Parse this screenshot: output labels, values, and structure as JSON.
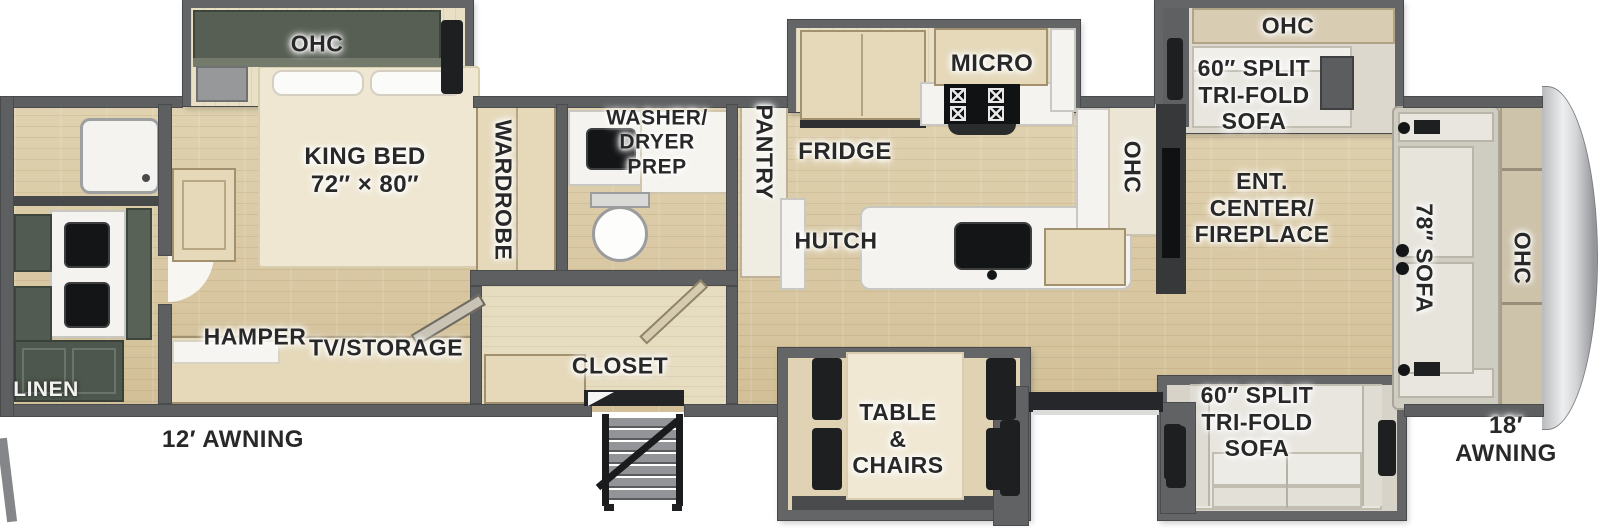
{
  "meta": {
    "type": "rv-fifth-wheel-floorplan",
    "width_px": 1600,
    "height_px": 528
  },
  "colors": {
    "wall": "#5e5f61",
    "floor_wood": "#d9c8a6",
    "cabinet_wood": "#e5d9ba",
    "cabinet_dark_green": "#525b51",
    "counter_white": "#f4f3ef",
    "sofa_fabric": "#e9e6e0",
    "front_cap_silver": "#c9cacc",
    "label_text": "#282828"
  },
  "bedroom": {
    "ohc": "OHC",
    "king_bed": [
      "KING BED",
      "72″ × 80″"
    ],
    "wardrobe": "WARDROBE",
    "hamper": "HAMPER",
    "tv_storage": "TV/STORAGE"
  },
  "rear_bath": {
    "linen": "LINEN"
  },
  "mid_bath": {
    "washer_dryer": [
      "WASHER/",
      "DRYER",
      "PREP"
    ],
    "pantry": "PANTRY"
  },
  "kitchen": {
    "micro": "MICRO",
    "fridge": "FRIDGE",
    "hutch": "HUTCH",
    "ohc": "OHC"
  },
  "living": {
    "ent_center": [
      "ENT.",
      "CENTER/",
      "FIREPLACE"
    ],
    "ohc_top": "OHC",
    "sofa_top": [
      "60″ SPLIT",
      "TRI-FOLD",
      "SOFA"
    ],
    "sofa_front": "78″ SOFA",
    "ohc_front": "OHC",
    "sofa_bottom": [
      "60″ SPLIT",
      "TRI-FOLD",
      "SOFA"
    ],
    "dinette": [
      "TABLE",
      "&",
      "CHAIRS"
    ],
    "closet": "CLOSET"
  },
  "exterior": {
    "awning_rear": "12′ AWNING",
    "awning_front": "18′ AWNING"
  }
}
